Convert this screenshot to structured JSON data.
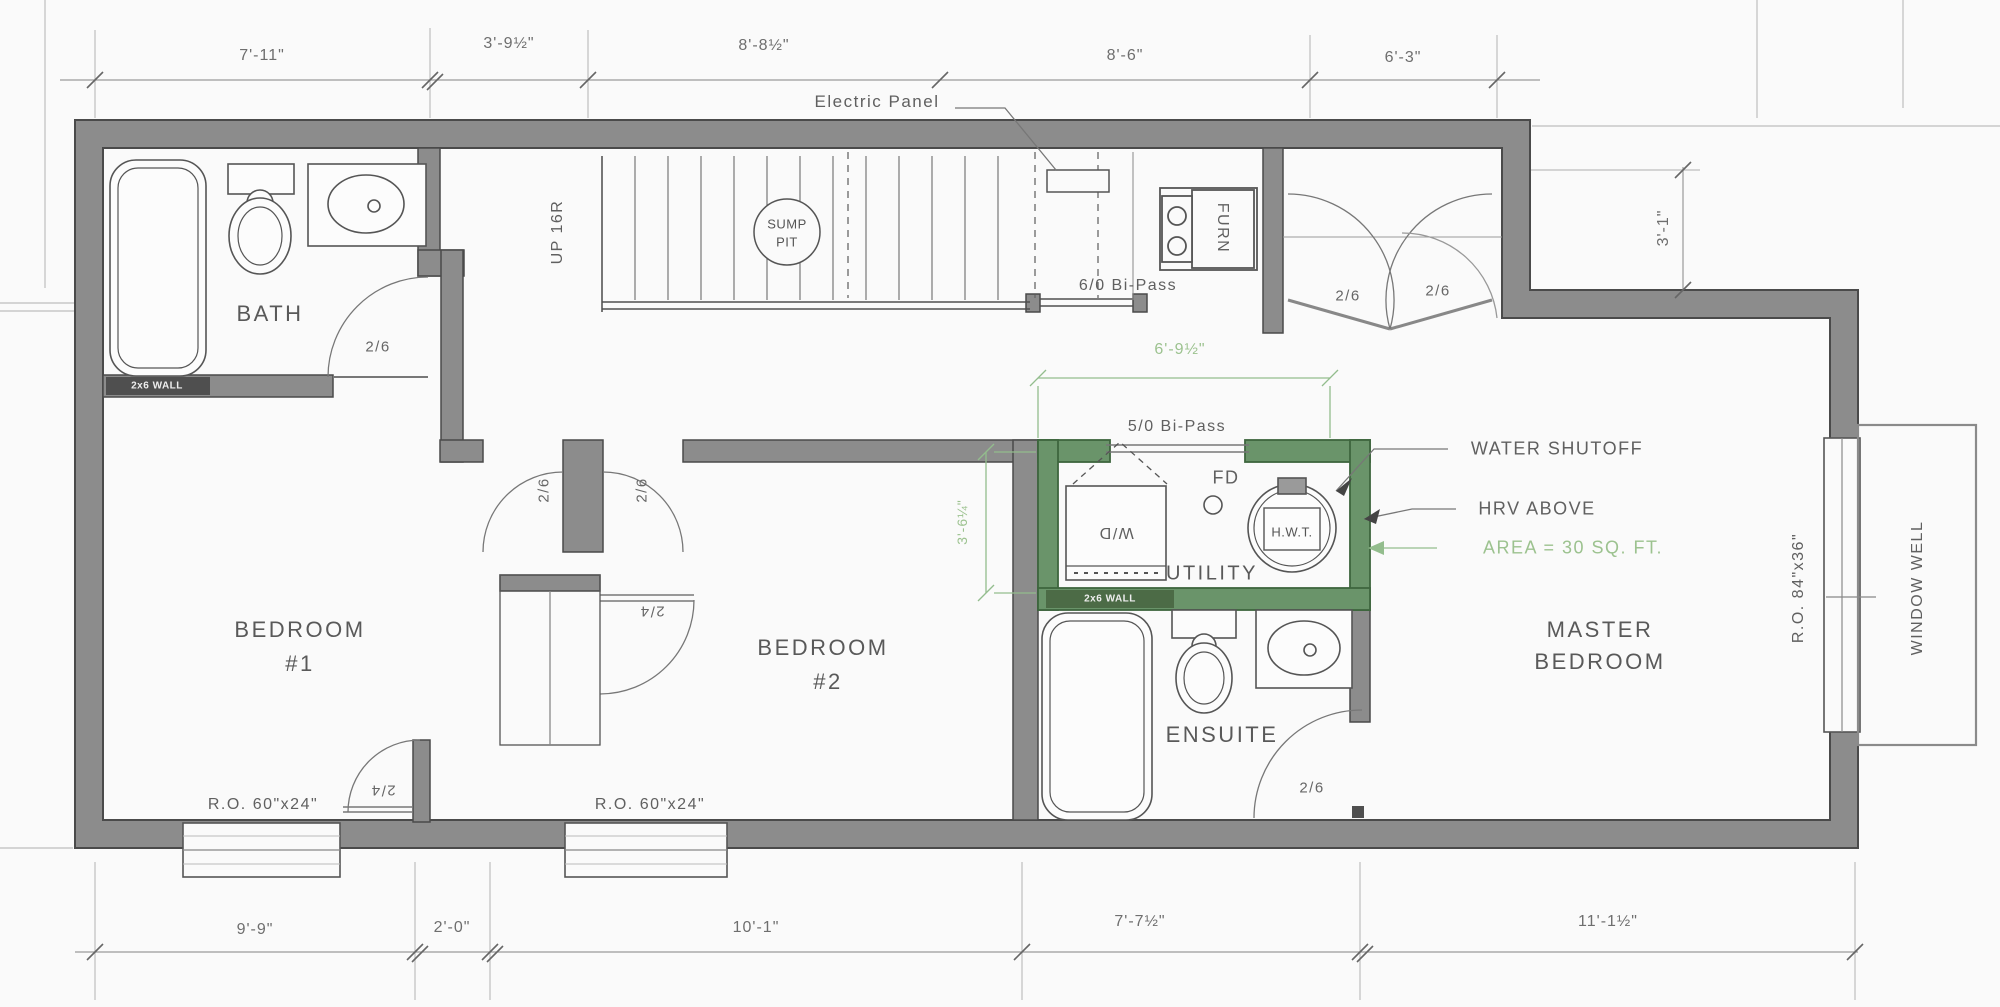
{
  "drawing": {
    "kind": "basement floor plan",
    "wall_color": "#8c8c8c",
    "green_accent": "#6a946a",
    "green_text": "#9cc28f"
  },
  "dims": {
    "top": [
      "7'-11\"",
      "3'-9½\"",
      "8'-8½\"",
      "8'-6\"",
      "6'-3\""
    ],
    "bottom": [
      "9'-9\"",
      "2'-0\"",
      "10'-1\"",
      "7'-7½\"",
      "11'-1½\""
    ],
    "right": "3'-1\"",
    "utility_width": "6'-9½\"",
    "utility_height": "3'-6¼\""
  },
  "rooms": {
    "bath": "BATH",
    "bedroom1_line1": "BEDROOM",
    "bedroom1_line2": "#1",
    "bedroom2_line1": "BEDROOM",
    "bedroom2_line2": "#2",
    "utility": "UTILITY",
    "ensuite": "ENSUITE",
    "master_line1": "MASTER",
    "master_line2": "BEDROOM"
  },
  "labels": {
    "electric_panel": "Electric Panel",
    "up_stairs": "UP 16R",
    "sump_line1": "SUMP",
    "sump_line2": "PIT",
    "furnace": "FURN",
    "bipass_60": "6/0 Bi-Pass",
    "bipass_50": "5/0 Bi-Pass",
    "washer_dryer": "W/D",
    "floor_drain": "FD",
    "hot_water_tank": "H.W.T.",
    "water_shutoff": "WATER SHUTOFF",
    "hrv_above": "HRV ABOVE",
    "area_note": "AREA = 30 SQ. FT.",
    "window_well": "WINDOW WELL",
    "ro_side_window": "R.O. 84\"x36\"",
    "ro_bottom_window": "R.O. 60\"x24\"",
    "wall_2x6": "2x6 WALL"
  },
  "doors": {
    "d26": "2/6",
    "d24": "2/4"
  }
}
